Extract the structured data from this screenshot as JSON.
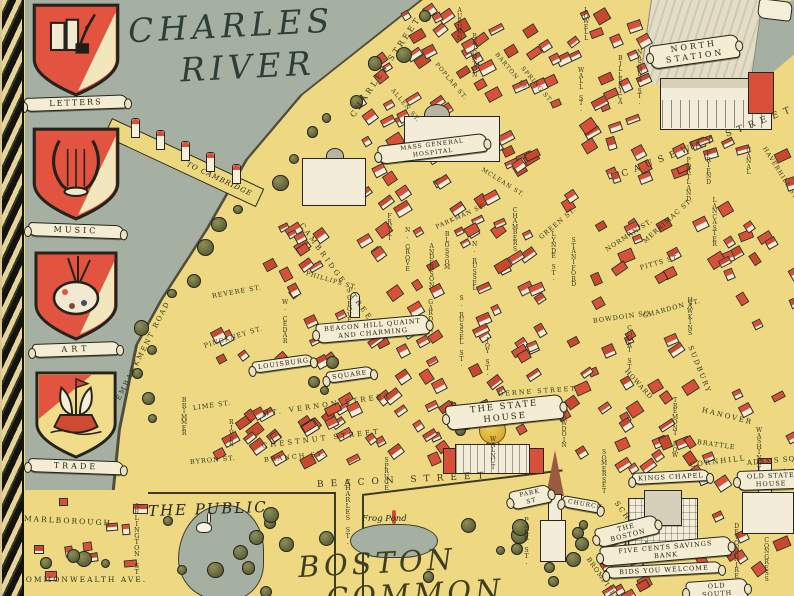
{
  "palette": {
    "water": "#a6b0a2",
    "land": "#eed982",
    "roof": "#d8503a",
    "wall": "#f6efda",
    "tree": "#6b6e41",
    "ink": "#26261a",
    "scroll": "#f5edd3",
    "dome_gold": "#d7a92e",
    "script_ink": "#2c3e37"
  },
  "heraldic_shields": [
    {
      "label": "LETTERS",
      "icon": "books-quill"
    },
    {
      "label": "MUSIC",
      "icon": "lyre"
    },
    {
      "label": "ART",
      "icon": "painters-palette"
    },
    {
      "label": "TRADE",
      "icon": "sailing-ship"
    }
  ],
  "places": {
    "river_line1": "CHARLES",
    "river_line2": "RIVER",
    "bridge_label": "TO CAMBRIDGE",
    "public_garden": "THE PUBLIC",
    "common_line1": "BOSTON",
    "common_line2": "COMMON",
    "frog_pond": "Frog Pond"
  },
  "banners": [
    {
      "id": "mass-general-hospital",
      "lines": [
        "MASS GENERAL HOSPITAL"
      ],
      "x": 378,
      "y": 146,
      "w": 110,
      "r": -7,
      "s": 6,
      "l": 1
    },
    {
      "id": "north-station",
      "lines": [
        "NORTH",
        "STATION"
      ],
      "x": 650,
      "y": 46,
      "w": 90,
      "r": -8,
      "s": 8,
      "l": 3
    },
    {
      "id": "beacon-hill",
      "lines": [
        "BEACON HILL QUAINT",
        "AND CHARMING"
      ],
      "x": 316,
      "y": 324,
      "w": 114,
      "r": -5,
      "s": 6.5,
      "l": 1
    },
    {
      "id": "louisburg",
      "lines": [
        "LOUISBURG"
      ],
      "x": 252,
      "y": 362,
      "w": 62,
      "r": -8,
      "s": 6.5,
      "l": 1
    },
    {
      "id": "square",
      "lines": [
        "SQUARE"
      ],
      "x": 326,
      "y": 372,
      "w": 48,
      "r": -8,
      "s": 6.5,
      "l": 1
    },
    {
      "id": "the-state-house",
      "lines": [
        "THE STATE HOUSE"
      ],
      "x": 446,
      "y": 406,
      "w": 118,
      "r": -6,
      "s": 8.5,
      "l": 2
    },
    {
      "id": "park-st",
      "lines": [
        "PARK ST"
      ],
      "x": 510,
      "y": 492,
      "w": 42,
      "r": -12,
      "s": 6,
      "l": 1
    },
    {
      "id": "church",
      "lines": [
        "CHURCH"
      ],
      "x": 562,
      "y": 495,
      "w": 40,
      "r": 10,
      "s": 6,
      "l": 1
    },
    {
      "id": "kings-chapel",
      "lines": [
        "KINGS CHAPEL"
      ],
      "x": 632,
      "y": 473,
      "w": 78,
      "r": -3,
      "s": 6.5,
      "l": 1
    },
    {
      "id": "old-state-house",
      "lines": [
        "OLD STATE",
        "HOUSE"
      ],
      "x": 737,
      "y": 471,
      "w": 68,
      "r": -2,
      "s": 6.5,
      "l": 1
    },
    {
      "id": "the-boston",
      "lines": [
        "THE BOSTON"
      ],
      "x": 596,
      "y": 529,
      "w": 64,
      "r": -14,
      "s": 6.5,
      "l": 1
    },
    {
      "id": "five-cents-savings-bank",
      "lines": [
        "FIVE CENTS SAVINGS BANK"
      ],
      "x": 600,
      "y": 547,
      "w": 132,
      "r": -5,
      "s": 6.5,
      "l": 1
    },
    {
      "id": "bids-you-welcome",
      "lines": [
        "BIDS YOU WELCOME"
      ],
      "x": 606,
      "y": 567,
      "w": 116,
      "r": -3,
      "s": 6.5,
      "l": 1
    },
    {
      "id": "old-south",
      "lines": [
        "OLD SOUTH"
      ],
      "x": 686,
      "y": 582,
      "w": 62,
      "r": -4,
      "s": 6.5,
      "l": 1
    }
  ],
  "streets": [
    {
      "n": "CHARLES STREET",
      "x": 352,
      "y": 112,
      "r": -56,
      "s": 8,
      "l": 3
    },
    {
      "n": "AUBURN",
      "x": 457,
      "y": 8,
      "st": 1,
      "s": 6
    },
    {
      "n": "BRIGHTON",
      "x": 472,
      "y": 34,
      "st": 1,
      "s": 6
    },
    {
      "n": "POPLAR ST.",
      "x": 436,
      "y": 60,
      "r": 50,
      "s": 6,
      "l": 1
    },
    {
      "n": "BARTON ST.",
      "x": 496,
      "y": 50,
      "r": 50,
      "s": 6,
      "l": 1
    },
    {
      "n": "SPRING ST.",
      "x": 522,
      "y": 64,
      "r": 50,
      "s": 6,
      "l": 1
    },
    {
      "n": "ALLEN ST.",
      "x": 392,
      "y": 86,
      "r": 50,
      "s": 6,
      "l": 1
    },
    {
      "n": "LOWELL",
      "x": 583,
      "y": 8,
      "st": 1,
      "s": 6
    },
    {
      "n": "WALL ST.",
      "x": 578,
      "y": 68,
      "st": 1,
      "s": 6
    },
    {
      "n": "NASHUA ST.",
      "x": 637,
      "y": 50,
      "st": 1,
      "s": 6
    },
    {
      "n": "BILLERICA",
      "x": 618,
      "y": 56,
      "st": 1,
      "s": 6
    },
    {
      "n": "CAUSEWAY STREET",
      "x": 622,
      "y": 170,
      "r": -21,
      "s": 9,
      "l": 6
    },
    {
      "n": "FRIEND",
      "x": 706,
      "y": 152,
      "st": 1,
      "s": 6
    },
    {
      "n": "PORTLAND",
      "x": 686,
      "y": 158,
      "st": 1,
      "s": 6
    },
    {
      "n": "CANAL",
      "x": 746,
      "y": 148,
      "st": 1,
      "s": 6
    },
    {
      "n": "HAVERHILL ST.",
      "x": 764,
      "y": 144,
      "r": 58,
      "s": 6,
      "l": 1
    },
    {
      "n": "MERRIMAC ST.",
      "x": 644,
      "y": 238,
      "r": -42,
      "s": 6.5,
      "l": 1
    },
    {
      "n": "LANCASTER",
      "x": 712,
      "y": 198,
      "st": 1,
      "s": 6
    },
    {
      "n": "NORMAN ST.",
      "x": 606,
      "y": 246,
      "r": -33,
      "s": 6.5,
      "l": 1
    },
    {
      "n": "PITTS ST.",
      "x": 640,
      "y": 264,
      "r": -16,
      "s": 6.5,
      "l": 1
    },
    {
      "n": "CHARDON ST.",
      "x": 643,
      "y": 312,
      "r": -15,
      "s": 6.5,
      "l": 1
    },
    {
      "n": "HAWKINS",
      "x": 687,
      "y": 298,
      "st": 1,
      "s": 6
    },
    {
      "n": "SUDBURY",
      "x": 690,
      "y": 342,
      "r": 68,
      "s": 7,
      "l": 2
    },
    {
      "n": "HANOVER",
      "x": 702,
      "y": 406,
      "r": 14,
      "s": 7,
      "l": 2
    },
    {
      "n": "HOWARD",
      "x": 626,
      "y": 366,
      "r": 48,
      "s": 6.5,
      "l": 1
    },
    {
      "n": "COURT ST.",
      "x": 627,
      "y": 326,
      "st": 1,
      "s": 6
    },
    {
      "n": "TREMONT ROW",
      "x": 672,
      "y": 398,
      "st": 1,
      "s": 6
    },
    {
      "n": "BRATTLE",
      "x": 697,
      "y": 438,
      "r": 8,
      "s": 6.5,
      "l": 1
    },
    {
      "n": "CORNHILL",
      "x": 690,
      "y": 461,
      "r": -7,
      "s": 7,
      "l": 2
    },
    {
      "n": "ADAMS SQ.",
      "x": 747,
      "y": 459,
      "r": -5,
      "s": 7,
      "l": 1
    },
    {
      "n": "WASHINGTON",
      "x": 756,
      "y": 428,
      "st": 1,
      "s": 6
    },
    {
      "n": "DEVONSHIRE",
      "x": 734,
      "y": 524,
      "st": 1,
      "s": 6
    },
    {
      "n": "CONGRESS",
      "x": 764,
      "y": 538,
      "st": 1,
      "s": 6
    },
    {
      "n": "SCHOOL ST.",
      "x": 616,
      "y": 498,
      "r": 55,
      "s": 7,
      "l": 2
    },
    {
      "n": "BROMFIELD",
      "x": 588,
      "y": 554,
      "r": 55,
      "s": 6.5,
      "l": 1
    },
    {
      "n": "PARK ST.",
      "x": 524,
      "y": 518,
      "st": 1,
      "s": 6.5
    },
    {
      "n": "SOMERSET",
      "x": 601,
      "y": 450,
      "st": 1,
      "s": 6
    },
    {
      "n": "BOWDOIN",
      "x": 561,
      "y": 410,
      "st": 1,
      "s": 6
    },
    {
      "n": "DERNE STREET",
      "x": 498,
      "y": 390,
      "r": -4,
      "s": 6.5,
      "l": 2
    },
    {
      "n": "BOWDOIN SQ.",
      "x": 593,
      "y": 317,
      "r": -8,
      "s": 6.5,
      "l": 1
    },
    {
      "n": "GREEN ST.",
      "x": 540,
      "y": 234,
      "r": -40,
      "s": 6.5,
      "l": 1
    },
    {
      "n": "LYNDE ST.",
      "x": 551,
      "y": 232,
      "st": 1,
      "s": 6
    },
    {
      "n": "STANIFORD",
      "x": 571,
      "y": 238,
      "st": 1,
      "s": 6
    },
    {
      "n": "CHAMBERS",
      "x": 512,
      "y": 208,
      "st": 1,
      "s": 6
    },
    {
      "n": "MCLEAN ST.",
      "x": 482,
      "y": 166,
      "r": 32,
      "s": 6,
      "l": 1
    },
    {
      "n": "PARKMAN ST.",
      "x": 436,
      "y": 224,
      "r": -24,
      "s": 6,
      "l": 1
    },
    {
      "n": "BLOSSOM",
      "x": 444,
      "y": 232,
      "st": 1,
      "s": 6
    },
    {
      "n": "N. RUSSEL",
      "x": 472,
      "y": 242,
      "st": 1,
      "s": 6
    },
    {
      "n": "N. GROVE",
      "x": 405,
      "y": 228,
      "st": 1,
      "s": 6
    },
    {
      "n": "ANDERSON",
      "x": 429,
      "y": 244,
      "st": 1,
      "s": 6
    },
    {
      "n": "FRUIT",
      "x": 387,
      "y": 214,
      "st": 1,
      "s": 6
    },
    {
      "n": "PHILLIPS ST.",
      "x": 306,
      "y": 270,
      "r": 16,
      "s": 6,
      "l": 1
    },
    {
      "n": "CAMBRIDGE STREET",
      "x": 301,
      "y": 220,
      "r": 54,
      "s": 7,
      "l": 3
    },
    {
      "n": "EMBANKMENT ROAD",
      "x": 118,
      "y": 396,
      "r": -63,
      "s": 7,
      "l": 2
    },
    {
      "n": "REVERE ST.",
      "x": 212,
      "y": 292,
      "r": -10,
      "s": 6.5,
      "l": 1
    },
    {
      "n": "PINCKNEY ST.",
      "x": 204,
      "y": 342,
      "r": -17,
      "s": 6.5,
      "l": 1
    },
    {
      "n": "W. CEDAR",
      "x": 282,
      "y": 300,
      "st": 1,
      "s": 6
    },
    {
      "n": "GROVE",
      "x": 347,
      "y": 296,
      "st": 1,
      "s": 6
    },
    {
      "n": "GARDEN",
      "x": 428,
      "y": 300,
      "st": 1,
      "s": 6
    },
    {
      "n": "S. RUSSEL ST.",
      "x": 459,
      "y": 296,
      "st": 1,
      "s": 6
    },
    {
      "n": "JOY ST.",
      "x": 485,
      "y": 338,
      "st": 1,
      "s": 6
    },
    {
      "n": "MT. VERNON STREET",
      "x": 262,
      "y": 410,
      "r": -8,
      "s": 7,
      "l": 3
    },
    {
      "n": "CHESTNUT STREET",
      "x": 262,
      "y": 442,
      "r": -7,
      "s": 7,
      "l": 3
    },
    {
      "n": "BRANCH ST.",
      "x": 264,
      "y": 456,
      "r": -6,
      "s": 6.5,
      "l": 2
    },
    {
      "n": "SPRUCE",
      "x": 384,
      "y": 458,
      "st": 1,
      "s": 6
    },
    {
      "n": "WALNUT",
      "x": 490,
      "y": 437,
      "st": 1,
      "s": 6
    },
    {
      "n": "BEACON STREET",
      "x": 317,
      "y": 480,
      "r": -3,
      "s": 9,
      "l": 7
    },
    {
      "n": "BYRON ST.",
      "x": 190,
      "y": 458,
      "r": -5,
      "s": 6.5,
      "l": 1
    },
    {
      "n": "LIME ST.",
      "x": 193,
      "y": 404,
      "r": -8,
      "s": 6.5,
      "l": 1
    },
    {
      "n": "RIVER",
      "x": 229,
      "y": 420,
      "st": 1,
      "s": 6
    },
    {
      "n": "BRIMMER",
      "x": 181,
      "y": 398,
      "st": 1,
      "s": 6
    },
    {
      "n": "CHARLES ST.",
      "x": 345,
      "y": 480,
      "st": 1,
      "s": 6.5
    },
    {
      "n": "MARLBOROUGH",
      "x": 24,
      "y": 514,
      "r": 3,
      "s": 7.5,
      "l": 2
    },
    {
      "n": "COMMONWEALTH AVE.",
      "x": 18,
      "y": 575,
      "r": 0,
      "s": 7.5,
      "l": 2
    },
    {
      "n": "ARLINGTON ST.",
      "x": 134,
      "y": 504,
      "st": 1,
      "s": 6.5
    }
  ]
}
